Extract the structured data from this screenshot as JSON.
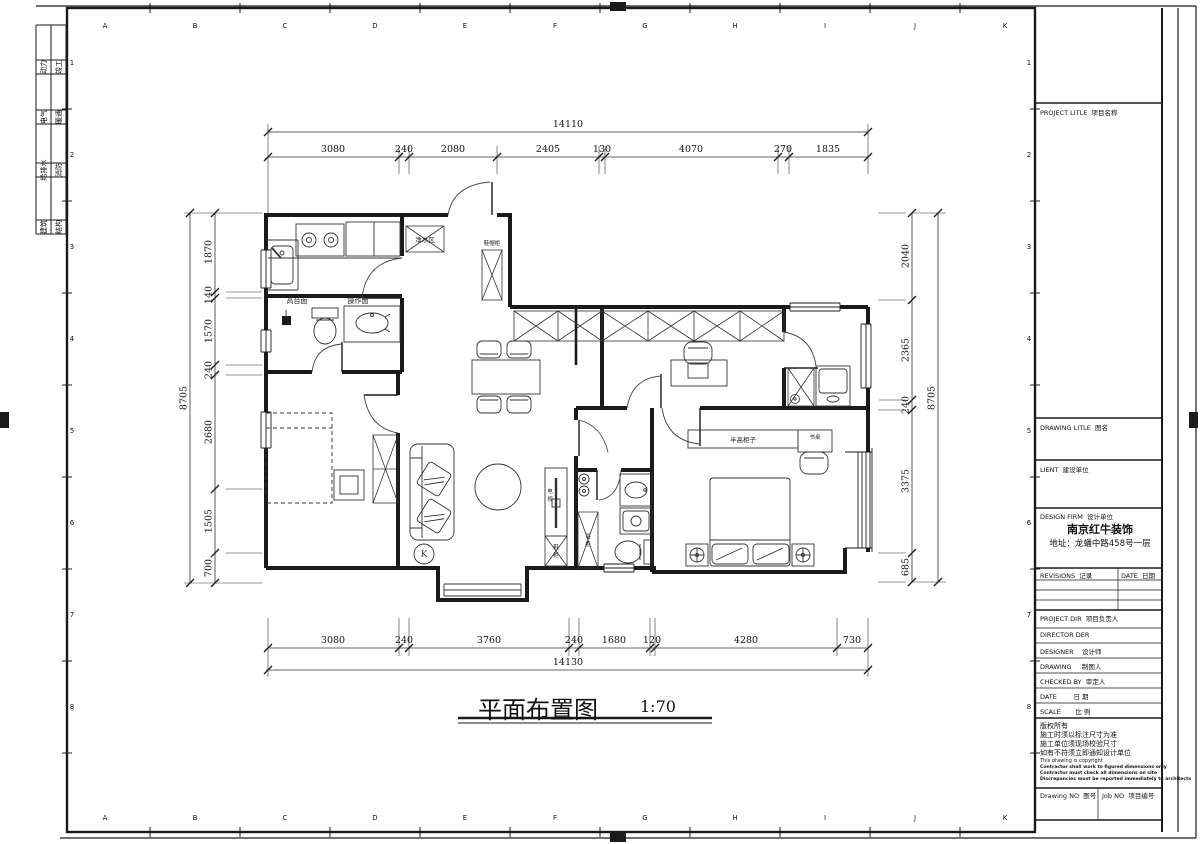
{
  "sheet": {
    "grid_letters": [
      "A",
      "B",
      "C",
      "D",
      "E",
      "F",
      "G",
      "H",
      "I",
      "J",
      "K"
    ],
    "grid_numbers": [
      "1",
      "2",
      "3",
      "4",
      "5",
      "6",
      "7",
      "8"
    ],
    "disciplines": [
      [
        "动力",
        "竣工"
      ],
      [
        "电气",
        "暖通"
      ],
      [
        "给排水",
        "消防"
      ],
      [
        "建筑",
        "结构"
      ]
    ],
    "line_color": "#1a1a1a"
  },
  "title": {
    "text": "平面布置图",
    "scale": "1:70"
  },
  "dims": {
    "top": {
      "overall": "14110",
      "segments": [
        "3080",
        "240",
        "2080",
        "2405",
        "130",
        "4070",
        "270",
        "1835"
      ]
    },
    "bottom": {
      "overall": "14130",
      "segments": [
        "3080",
        "240",
        "3760",
        "240",
        "1680",
        "120",
        "4280",
        "730"
      ]
    },
    "left": {
      "overall": "8705",
      "segments": [
        "1870",
        "140",
        "1570",
        "240",
        "2680",
        "1505",
        "700"
      ]
    },
    "right": {
      "overall": "8705",
      "segments": [
        "2040",
        "2365",
        "240",
        "3375",
        "685"
      ]
    }
  },
  "plan_labels": {
    "counter_high": "高台面",
    "counter_work": "操作面",
    "purifier": "净水区",
    "entry_cabinet": "鞋帽柜",
    "half_cabinet": "半高柜子",
    "desk": "书桌",
    "tv": "电视",
    "shoe_cabinet": "鞋柜",
    "bath_cabinet": "浴柜",
    "k_mark": "K"
  },
  "title_block": {
    "project_title": "PROJECT LITLE  项目名称",
    "drawing_title": "DRAWING LITLE  图名",
    "client": "LIENT  建设单位",
    "design_firm": "DESIGN FIRM  设计单位",
    "firm_name": "南京红牛装饰",
    "firm_address": "地址：龙蟠中路458号一层",
    "revisions": "REVISIONS  记录",
    "date_col": "DATE  日期",
    "project_dir": "PROJECT DIR  项目负责人",
    "director": "DIRECTOR DER",
    "designer": "DESIGNER    设计师",
    "drawing_by": "DRAWING     制图人",
    "checked_by": "CHECKED BY  审定人",
    "date_row": "DATE        日 期",
    "scale_row": "SCALE       比 例",
    "copyright_cn": [
      "版权所有",
      "施工时须以标注尺寸为准",
      "施工单位须现场校验尺寸",
      "如有不符须立即通知设计单位"
    ],
    "copyright_en": [
      "This drawing is copyright",
      "Contractor shall work to figured dimensions only",
      "Contractor must check all dimensions on site",
      "Discrepancies must be reported immediately to architects"
    ],
    "drawing_no": "Drawing NO  图号",
    "job_no": "Job NO  项目编号"
  }
}
